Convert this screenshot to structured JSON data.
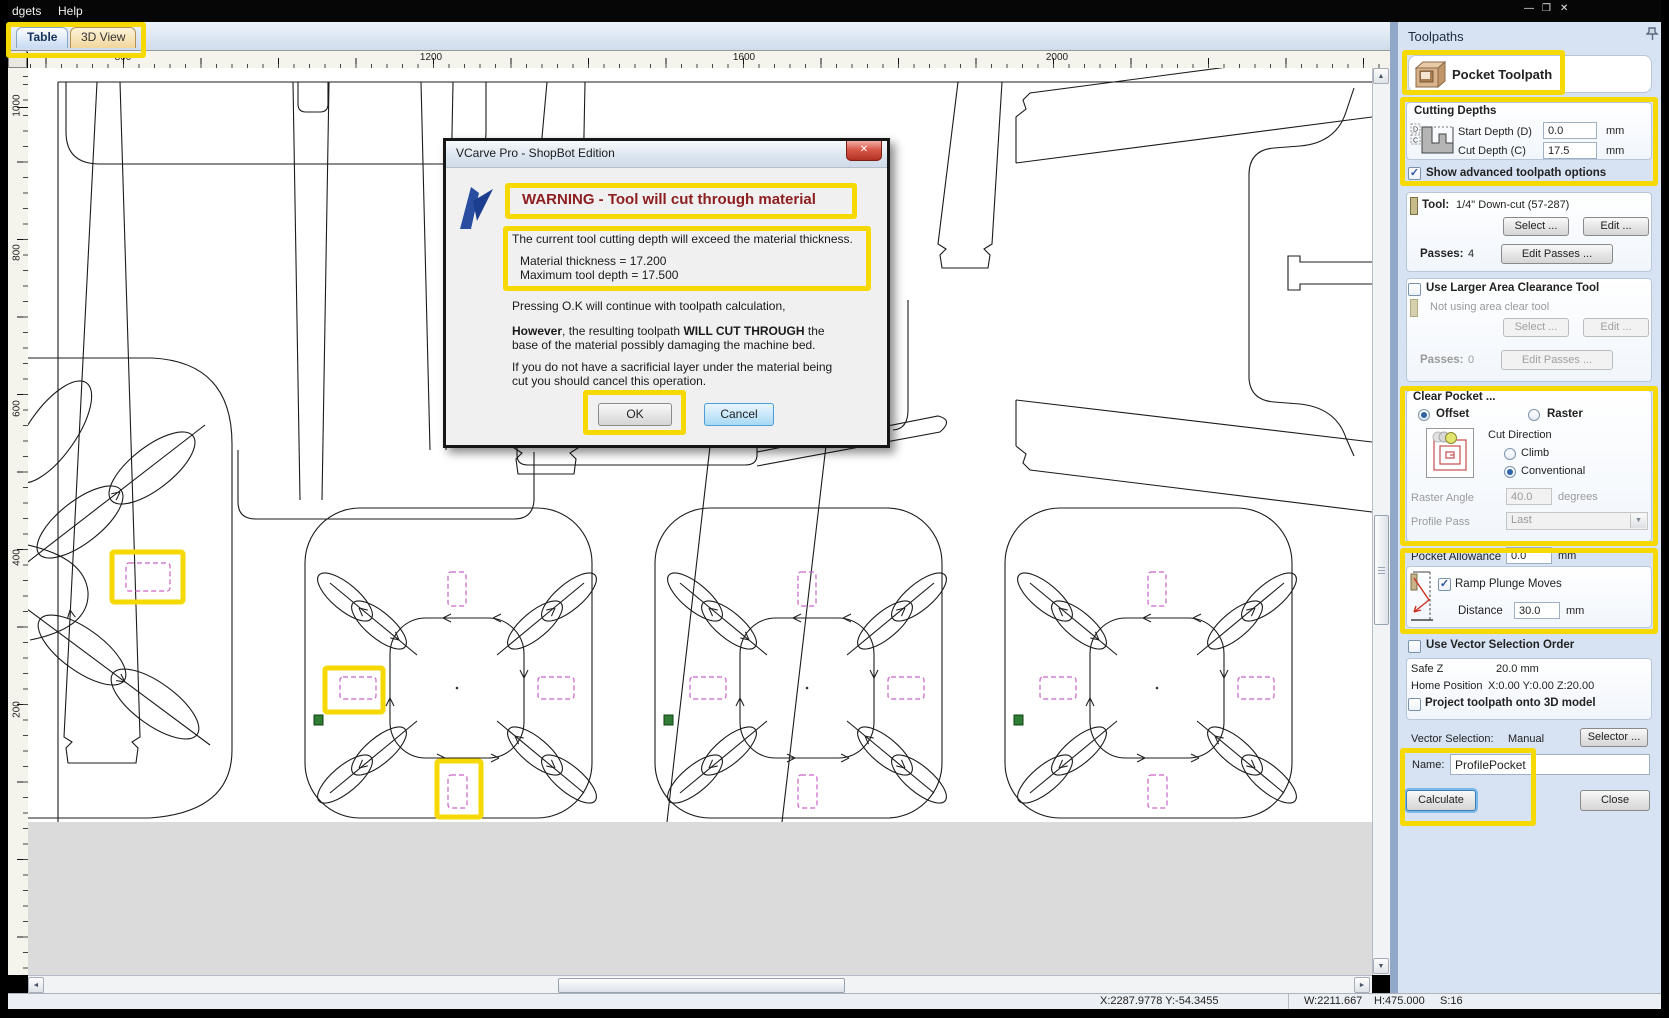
{
  "menu": {
    "items": [
      "dgets",
      "Help"
    ]
  },
  "icons": {
    "check": "✓",
    "dropdown": "▼",
    "up": "▲",
    "down": "▼",
    "left": "◄",
    "right": "►",
    "close": "✕",
    "minimize": "—",
    "restore": "❐"
  },
  "tabs": [
    {
      "label": "Table"
    },
    {
      "label": "3D View"
    }
  ],
  "rulers": {
    "top": [
      "800",
      "1200",
      "1600",
      "2000"
    ],
    "left": [
      "1000",
      "800",
      "600",
      "400",
      "200"
    ]
  },
  "dialog": {
    "title": "VCarve Pro - ShopBot Edition",
    "heading": "WARNING - Tool will cut through material",
    "line1": "The current tool cutting depth will exceed the material thickness.",
    "material_thickness": "Material thickness = 17.200",
    "max_tool_depth": "Maximum tool depth = 17.500",
    "para_ok": "Pressing O.K will continue with toolpath calculation,",
    "para_however": {
      "s1": "However",
      "s2": ", the resulting toolpath ",
      "s3": "WILL CUT THROUGH",
      "s4": " the base of the material possibly damaging the machine bed."
    },
    "para_sacrificial": "If you do not have a sacrificial layer under the material being cut you should cancel this operation.",
    "ok_label": "OK",
    "cancel_label": "Cancel"
  },
  "panel": {
    "title": "Toolpaths",
    "pocket_header": "Pocket Toolpath",
    "cutting_depths": {
      "heading": "Cutting Depths",
      "start_label": "Start Depth (D)",
      "start_value": "0.0",
      "cut_label": "Cut Depth (C)",
      "cut_value": "17.5",
      "unit": "mm",
      "icon_d": "D",
      "icon_c": "C"
    },
    "show_advanced": "Show advanced toolpath options",
    "tool": {
      "label": "Tool:",
      "value": "1/4\" Down-cut (57-287)",
      "select": "Select ...",
      "edit": "Edit ...",
      "passes_label": "Passes:",
      "passes_value": "4",
      "edit_passes": "Edit Passes ..."
    },
    "area_clear": {
      "label": "Use Larger Area Clearance Tool",
      "status": "Not using area clear tool",
      "select": "Select ...",
      "edit": "Edit ...",
      "passes_label": "Passes:",
      "passes_value": "0",
      "edit_passes": "Edit Passes ..."
    },
    "clear_pocket": {
      "heading": "Clear Pocket ...",
      "offset": "Offset",
      "raster": "Raster",
      "cut_direction": "Cut Direction",
      "climb": "Climb",
      "conventional": "Conventional",
      "raster_angle_label": "Raster Angle",
      "raster_angle_value": "40.0",
      "degrees_label": "degrees",
      "profile_pass_label": "Profile Pass",
      "profile_pass_value": "Last"
    },
    "pocket_allowance": {
      "label": "Pocket Allowance",
      "value": "0.0",
      "unit": "mm"
    },
    "ramp": {
      "label": "Ramp Plunge Moves",
      "distance_label": "Distance",
      "distance_value": "30.0",
      "unit": "mm"
    },
    "vector_order": "Use Vector Selection Order",
    "info": {
      "safe_z_label": "Safe Z",
      "safe_z_value": "20.0 mm",
      "home_label": "Home Position",
      "home_value": "X:0.00 Y:0.00 Z:20.00",
      "project": "Project toolpath onto 3D model"
    },
    "vector_selection": {
      "label": "Vector Selection:",
      "value": "Manual",
      "selector": "Selector ..."
    },
    "name": {
      "label": "Name:",
      "value": "ProfilePocket"
    },
    "calculate": "Calculate",
    "close": "Close"
  },
  "status": {
    "cursor": "X:2287.9778 Y:-54.3455",
    "w": "W:2211.667",
    "h": "H:475.000",
    "s": "S:16"
  }
}
